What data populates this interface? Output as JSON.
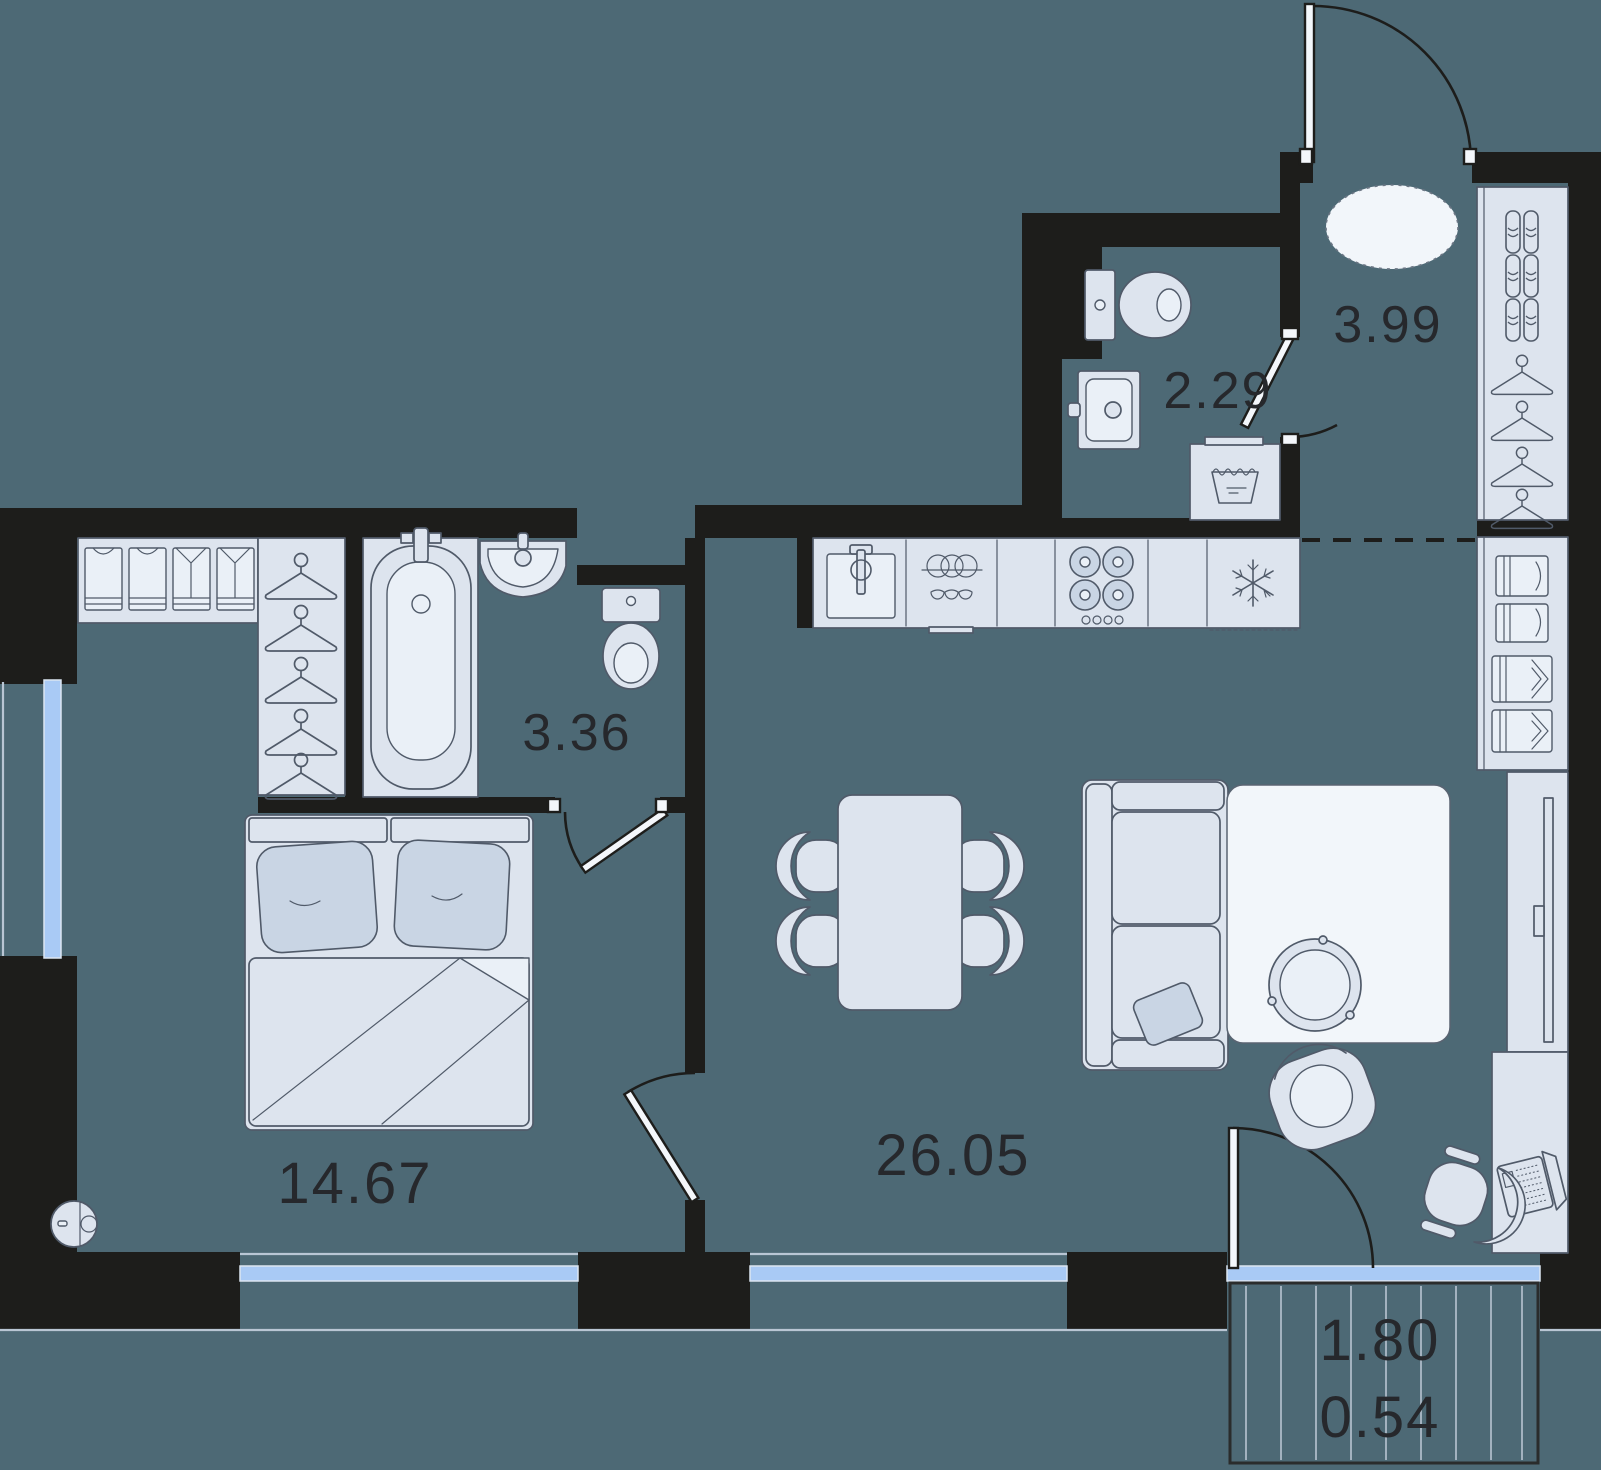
{
  "document": {
    "type": "apartment-floor-plan"
  },
  "labels": {
    "bedroom_area": "14.67",
    "living_room_area": "26.05",
    "bathroom_area": "3.36",
    "wc_area": "2.29",
    "hallway_area": "3.99",
    "balcony_area_full": "1.80",
    "balcony_area_reduced": "0.54"
  },
  "colors": {
    "background": "#4d6975",
    "walls": "#1d1d1b",
    "furniture_fill": "#dde4ee",
    "furniture_stroke": "#505a69",
    "window_glass": "#a9caf5",
    "rug_fill": "#f2f6fa",
    "pillow_fill": "#c9d5e4",
    "label_text": "#26282c"
  },
  "icons": {
    "bathtub-icon": "svg-shape",
    "bath-sink-icon": "svg-shape",
    "bath-toilet-icon": "svg-shape",
    "wc-toilet-icon": "svg-shape",
    "wc-sink-icon": "svg-shape",
    "washing-machine-icon": "svg-shape",
    "kitchen-sink-icon": "svg-shape",
    "dishwasher-icon": "svg-shape",
    "cooktop-icon": "svg-shape",
    "fridge-snowflake-icon": "svg-shape",
    "dining-table-icon": "svg-shape",
    "chair-icon": "svg-shape",
    "sofa-icon": "svg-shape",
    "coffee-table-icon": "svg-shape",
    "armchair-icon": "svg-shape",
    "tv-icon": "svg-shape",
    "desk-icon": "svg-shape",
    "laptop-icon": "svg-shape",
    "office-chair-icon": "svg-shape",
    "hanger-icon": "svg-shape",
    "shoe-icon": "svg-shape",
    "folded-clothes-icon": "svg-shape",
    "robot-vacuum-icon": "svg-shape",
    "entry-rug-icon": "svg-shape",
    "bed-icon": "svg-shape"
  }
}
